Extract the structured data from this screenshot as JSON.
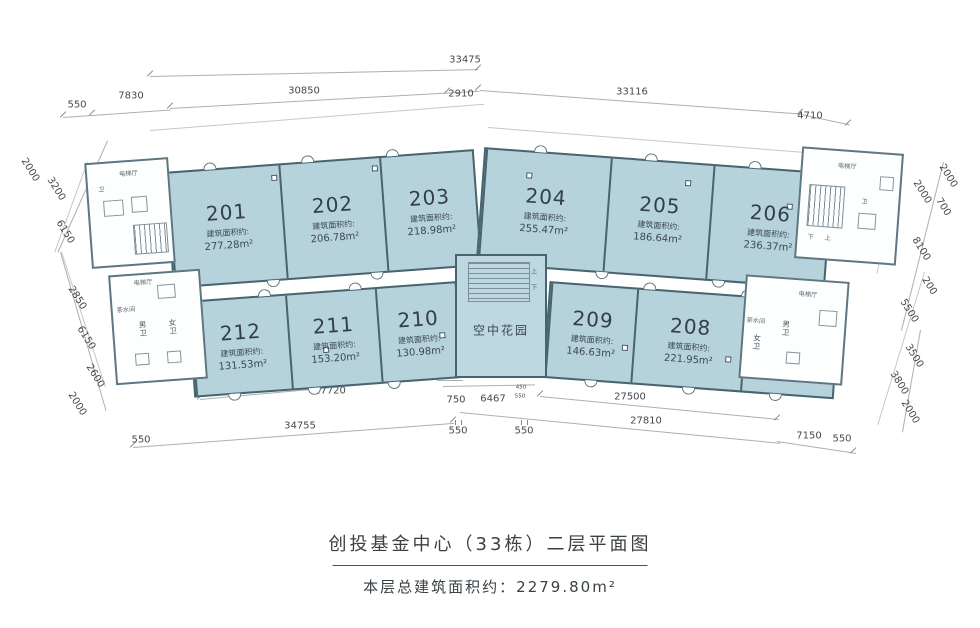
{
  "colors": {
    "room_fill": "#b6d2db",
    "wall": "#48656f",
    "garden_fill": "#bdd8e0",
    "dim_text": "#45494c"
  },
  "title": {
    "line1": "创投基金中心（33栋）二层平面图",
    "line2": "本层总建筑面积约：2279.80m²"
  },
  "labels": {
    "area_prefix": "建筑面积约:",
    "elevator_hall": "电梯厅",
    "tea_room": "茶水间",
    "male_wc": "男卫",
    "female_wc": "女卫",
    "wc": "卫",
    "garden": "空中花园",
    "up": "上",
    "down": "下"
  },
  "rooms": [
    {
      "number": "201",
      "area": "277.28m²"
    },
    {
      "number": "202",
      "area": "206.78m²"
    },
    {
      "number": "203",
      "area": "218.98m²"
    },
    {
      "number": "204",
      "area": "255.47m²"
    },
    {
      "number": "205",
      "area": "186.64m²"
    },
    {
      "number": "206",
      "area": "236.37m²"
    },
    {
      "number": "207",
      "area": "113.99m²"
    },
    {
      "number": "208",
      "area": "221.95m²"
    },
    {
      "number": "209",
      "area": "146.63m²"
    },
    {
      "number": "210",
      "area": "130.98m²"
    },
    {
      "number": "211",
      "area": "153.20m²"
    },
    {
      "number": "212",
      "area": "131.53m²"
    }
  ],
  "dims": {
    "top": [
      "33475",
      "550",
      "7830",
      "30850",
      "2910",
      "33116",
      "4710"
    ],
    "left": [
      "2000",
      "3200",
      "6150",
      "2850",
      "6150",
      "2600",
      "2000"
    ],
    "right": [
      "2000",
      "2000",
      "700",
      "8100",
      "200",
      "5500",
      "3500",
      "3800",
      "2000"
    ],
    "bottom": [
      "27720",
      "550",
      "750",
      "6467",
      "450",
      "550",
      "34755",
      "550",
      "550",
      "550",
      "27500",
      "27810",
      "7150",
      "550"
    ]
  }
}
